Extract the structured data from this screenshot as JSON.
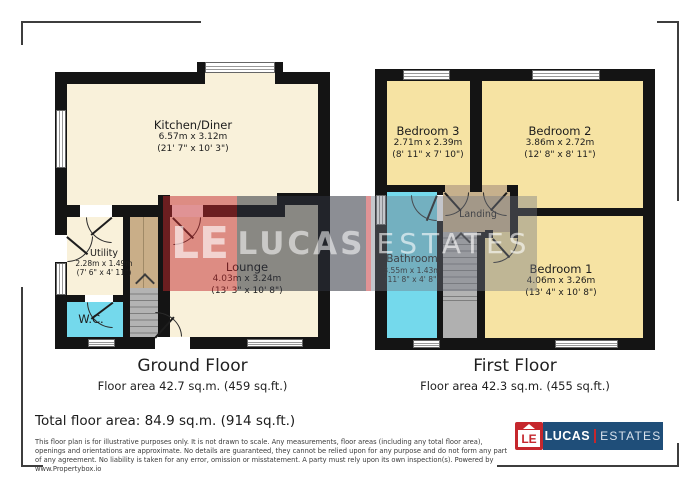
{
  "watermark": {
    "monogram": "LE",
    "brand": "LUCAS",
    "suffix": "ESTATES"
  },
  "ground_floor": {
    "title": "Ground Floor",
    "floor_area": "Floor area 42.7 sq.m. (459 sq.ft.)",
    "rooms": {
      "kitchen_diner": {
        "name": "Kitchen/Diner",
        "metric": "6.57m x 3.12m",
        "imperial": "(21' 7\" x 10' 3\")"
      },
      "lounge": {
        "name": "Lounge",
        "metric": "4.03m x 3.24m",
        "imperial": "(13' 3\" x 10' 8\")"
      },
      "utility": {
        "name": "Utility",
        "metric": "2.28m x 1.49m",
        "imperial": "(7' 6\" x 4' 11\")"
      },
      "wc": {
        "name": "W.C."
      }
    }
  },
  "first_floor": {
    "title": "First Floor",
    "floor_area": "Floor area 42.3 sq.m. (455 sq.ft.)",
    "rooms": {
      "bedroom_3": {
        "name": "Bedroom 3",
        "metric": "2.71m x 2.39m",
        "imperial": "(8' 11\" x 7' 10\")"
      },
      "bedroom_2": {
        "name": "Bedroom 2",
        "metric": "3.86m x 2.72m",
        "imperial": "(12' 8\" x 8' 11\")"
      },
      "bedroom_1": {
        "name": "Bedroom 1",
        "metric": "4.06m x 3.26m",
        "imperial": "(13' 4\" x 10' 8\")"
      },
      "bathroom": {
        "name": "Bathroom",
        "metric": "3.55m x 1.43m",
        "imperial": "(11' 8\" x 4' 8\")"
      },
      "landing": {
        "name": "Landing"
      }
    }
  },
  "footer": {
    "total_area": "Total floor area: 84.9 sq.m. (914 sq.ft.)",
    "disclaimer": "This floor plan is for illustrative purposes only. It is not drawn to scale. Any measurements, floor areas (including any total floor area), openings and orientations are approximate. No details are guaranteed, they cannot be relied upon for any purpose and do not form any part of any agreement. No liability is taken for any error, omission or misstatement. A party must rely upon its own inspection(s). Powered by www.Propertybox.io"
  },
  "logo": {
    "monogram": "LE",
    "brand": "LUCAS",
    "suffix": "ESTATES"
  },
  "colors": {
    "room_cream": "#F9F1DA",
    "room_yellow": "#F6E3A3",
    "room_cyan": "#74D9EC",
    "landing_tan": "#C6B08C",
    "wall": "#141414",
    "logo_navy": "#1F4E79",
    "logo_red": "#C5272D"
  }
}
